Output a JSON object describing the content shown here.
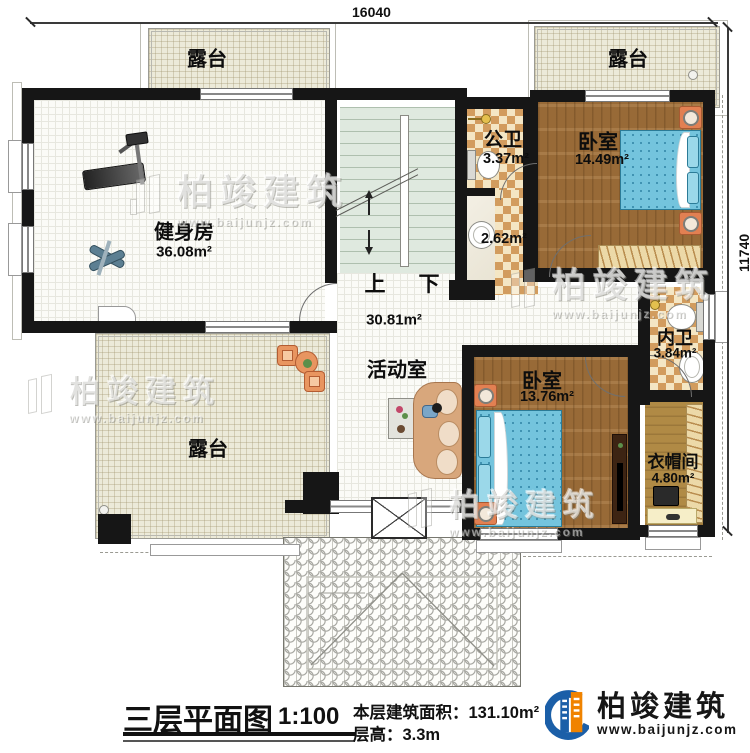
{
  "dimensions": {
    "top": "16040",
    "right": "11740"
  },
  "stairs": {
    "up": "上",
    "down": "下"
  },
  "rooms": {
    "terrace_top_left": {
      "label": "露台"
    },
    "terrace_top_right": {
      "label": "露台"
    },
    "terrace_bottom_left": {
      "label": "露台"
    },
    "gym": {
      "label": "健身房",
      "area": "36.08m²"
    },
    "public_bathroom": {
      "label": "公卫",
      "area": "3.37m²"
    },
    "shower_room": {
      "area": "2.62m²"
    },
    "bedroom_top": {
      "label": "卧室",
      "area": "14.49m²"
    },
    "ensuite_bathroom": {
      "label": "内卫",
      "area": "3.84m²"
    },
    "activity_room": {
      "label": "活动室",
      "area": "30.81m²"
    },
    "bedroom_bottom": {
      "label": "卧室",
      "area": "13.76m²"
    },
    "cloakroom": {
      "label": "衣帽间",
      "area": "4.80m²"
    }
  },
  "title": {
    "main": "三层平面图",
    "scale": "1:100",
    "area_line": "本层建筑面积：131.10m²",
    "height_line": "层高：3.3m"
  },
  "logo": {
    "name": "柏竣建筑",
    "url": "www.baijunjz.com"
  },
  "watermark": {
    "name": "柏竣建筑",
    "url": "www.baijunjz.com"
  },
  "colors": {
    "logo_blue": "#1b5fa8",
    "logo_orange": "#f08300",
    "wall": "#161616"
  }
}
